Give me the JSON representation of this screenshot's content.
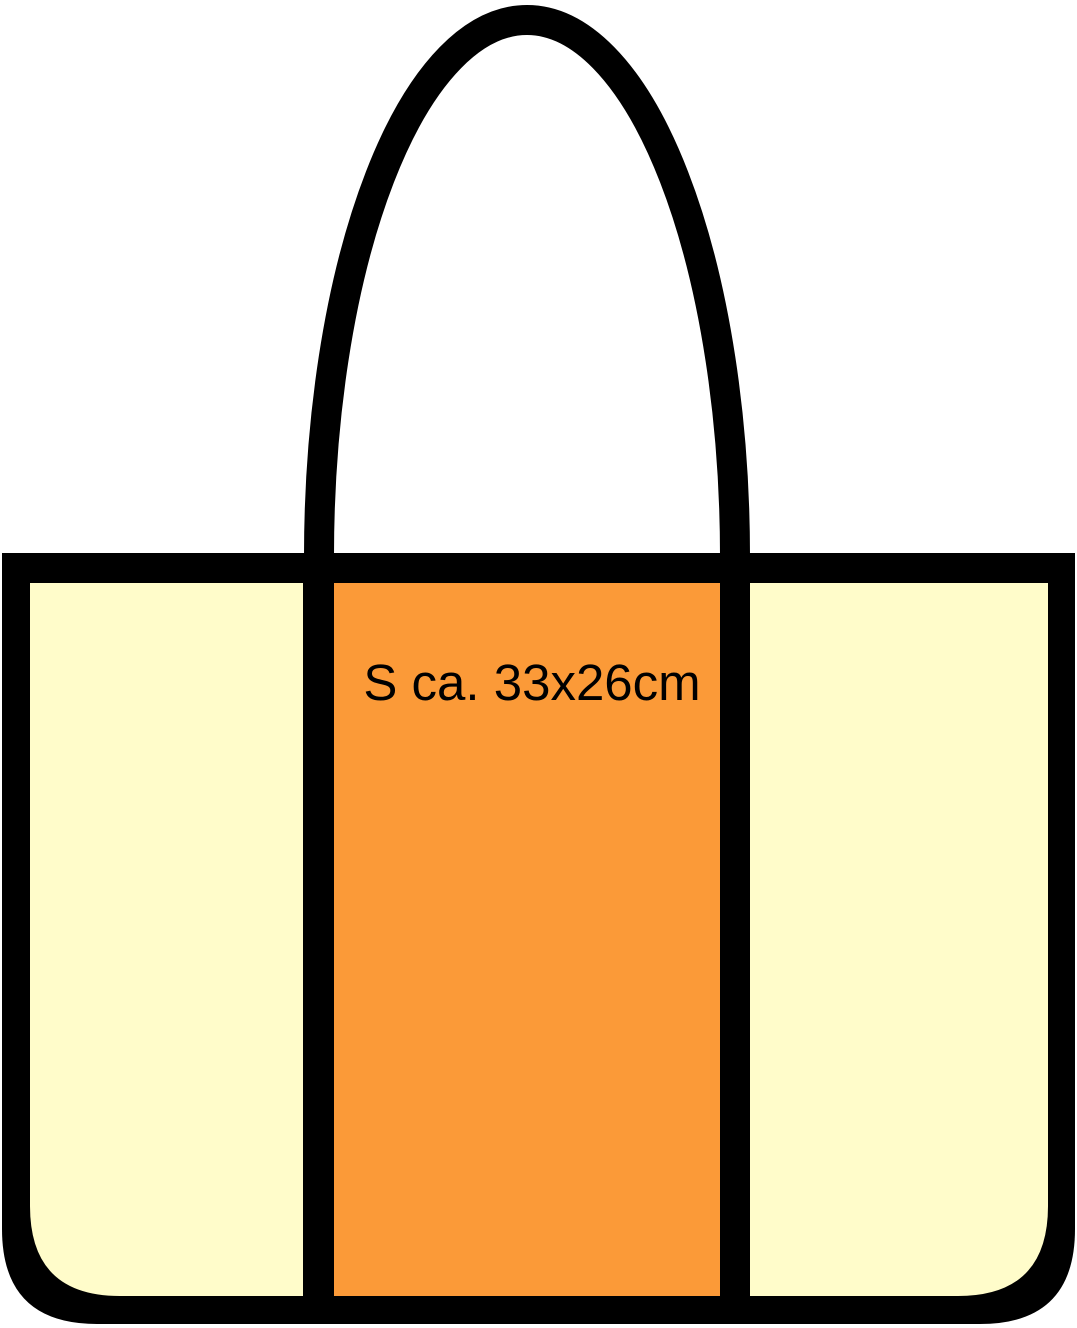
{
  "diagram": {
    "title": "tote bag print-area diagram",
    "print_area_label": "S ca. 33x26cm"
  },
  "colors": {
    "outline": "#000000",
    "panel_cream": "#FFFCCA",
    "panel_orange": "#FB9A38",
    "label_text": "#000000",
    "background": "#FFFFFF"
  }
}
